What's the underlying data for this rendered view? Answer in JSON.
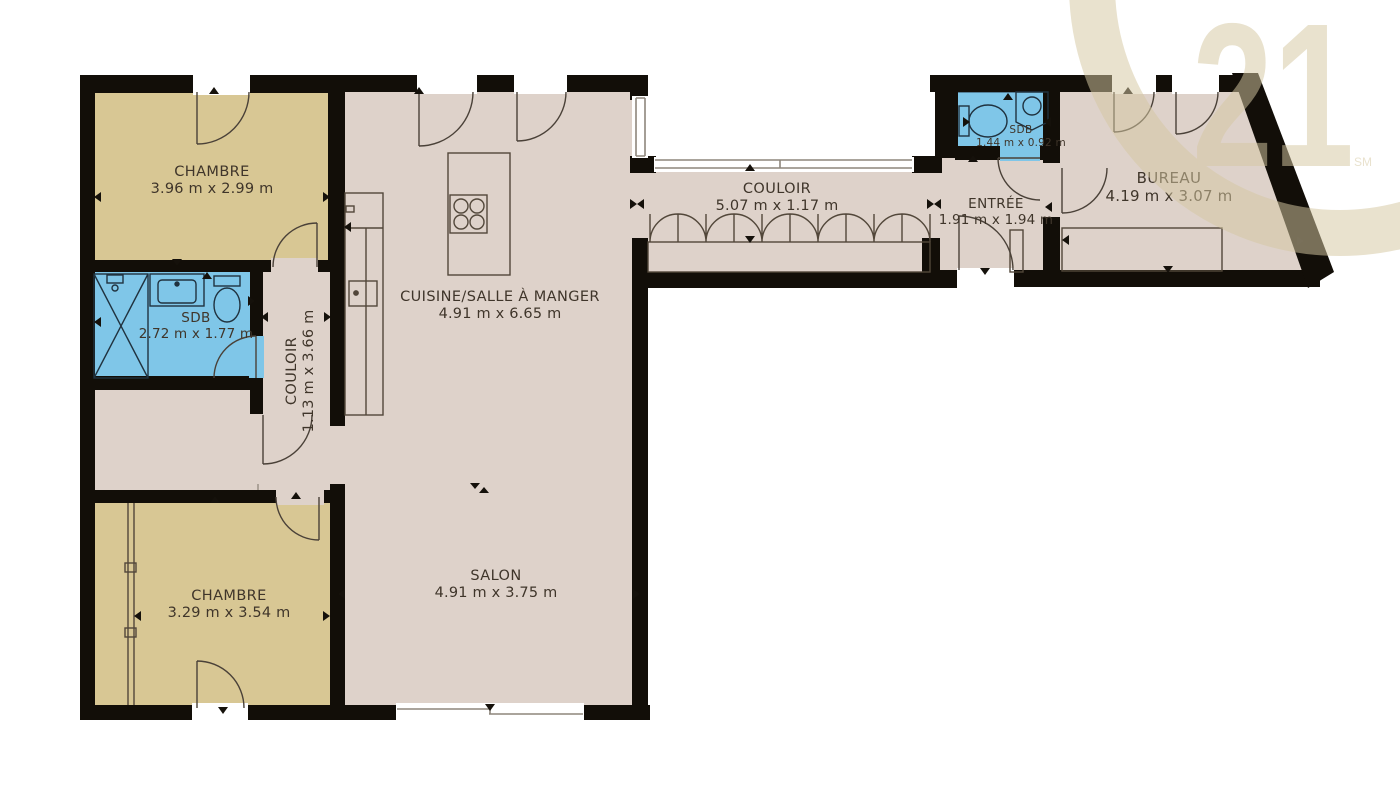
{
  "brand": {
    "logo_number": "21",
    "trademark": "SM"
  },
  "rooms": {
    "chambre1": {
      "label": "CHAMBRE",
      "dims": "3.96 m x 2.99 m"
    },
    "sdb1": {
      "label": "SDB",
      "dims": "2.72 m x 1.77 m"
    },
    "couloir1": {
      "label": "COULOIR",
      "dims": "1.13 m x 3.66 m"
    },
    "cuisine": {
      "label": "CUISINE/SALLE À MANGER",
      "dims": "4.91 m x 6.65 m"
    },
    "couloir2": {
      "label": "COULOIR",
      "dims": "5.07 m x 1.17 m"
    },
    "salon": {
      "label": "SALON",
      "dims": "4.91 m x 3.75 m"
    },
    "chambre2": {
      "label": "CHAMBRE",
      "dims": "3.29 m x 3.54 m"
    },
    "entree": {
      "label": "ENTRÉE",
      "dims": "1.91 m x 1.94 m"
    },
    "sdb2": {
      "label": "SDB",
      "dims": "1.44 m x 0.92 m"
    },
    "bureau": {
      "label": "BUREAU",
      "dims": "4.19 m x 3.07 m"
    }
  },
  "colors": {
    "wall": "#120e08",
    "bedroom_floor": "#d8c794",
    "living_floor": "#ded2ca",
    "bathroom_floor": "#7fc6e8",
    "logo_beige": "#d5c8a2",
    "label_text": "#3f352a"
  }
}
